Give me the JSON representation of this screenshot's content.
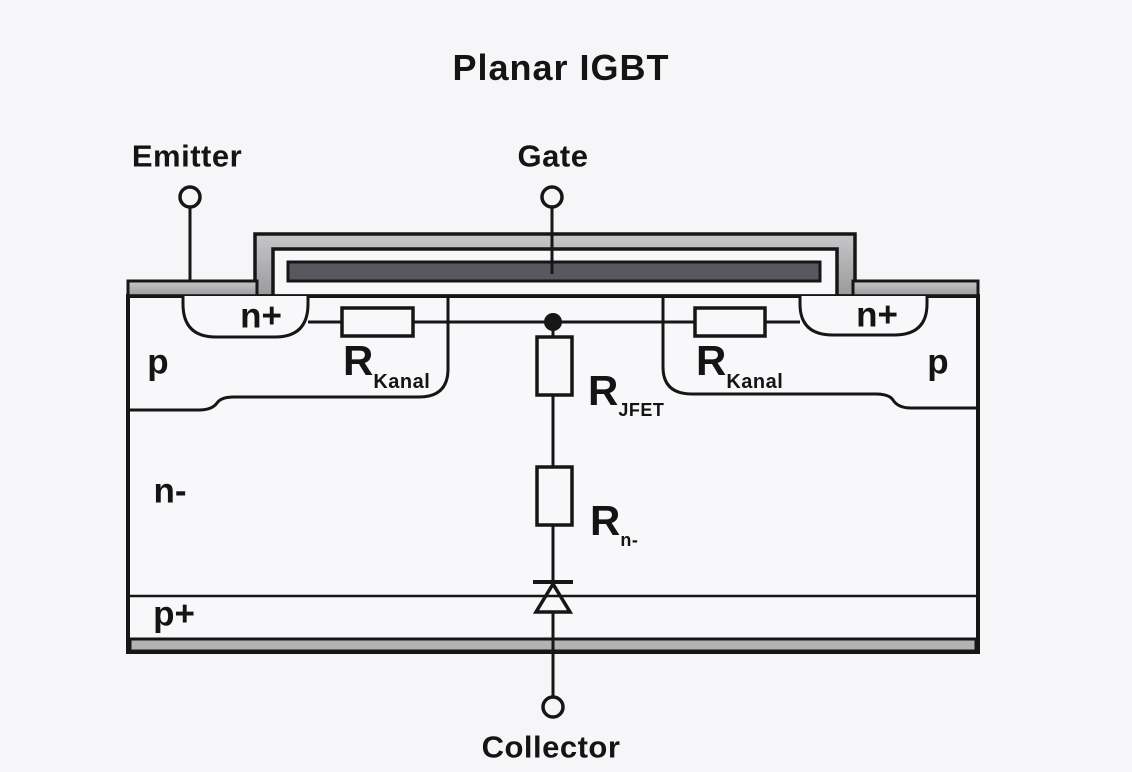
{
  "title": "Planar IGBT",
  "terminals": {
    "emitter": "Emitter",
    "gate": "Gate",
    "collector": "Collector"
  },
  "regions": {
    "n_plus_left": "n+",
    "n_plus_right": "n+",
    "p_left": "p",
    "p_right": "p",
    "n_minus": "n-",
    "p_plus": "p+"
  },
  "resistors": {
    "kanal_left": {
      "base": "R",
      "sub": "Kanal"
    },
    "kanal_right": {
      "base": "R",
      "sub": "Kanal"
    },
    "jfet": {
      "base": "R",
      "sub": "JFET"
    },
    "n_drift": {
      "base": "R",
      "sub": "n-"
    }
  },
  "colors": {
    "background": "#f6f5f7",
    "line": "#161616",
    "metal_light_top": "#c5c4c6",
    "metal_light_bottom": "#9b999b",
    "gate_electrode": "#5a585e",
    "collector_metal": "#b4b2b4"
  }
}
